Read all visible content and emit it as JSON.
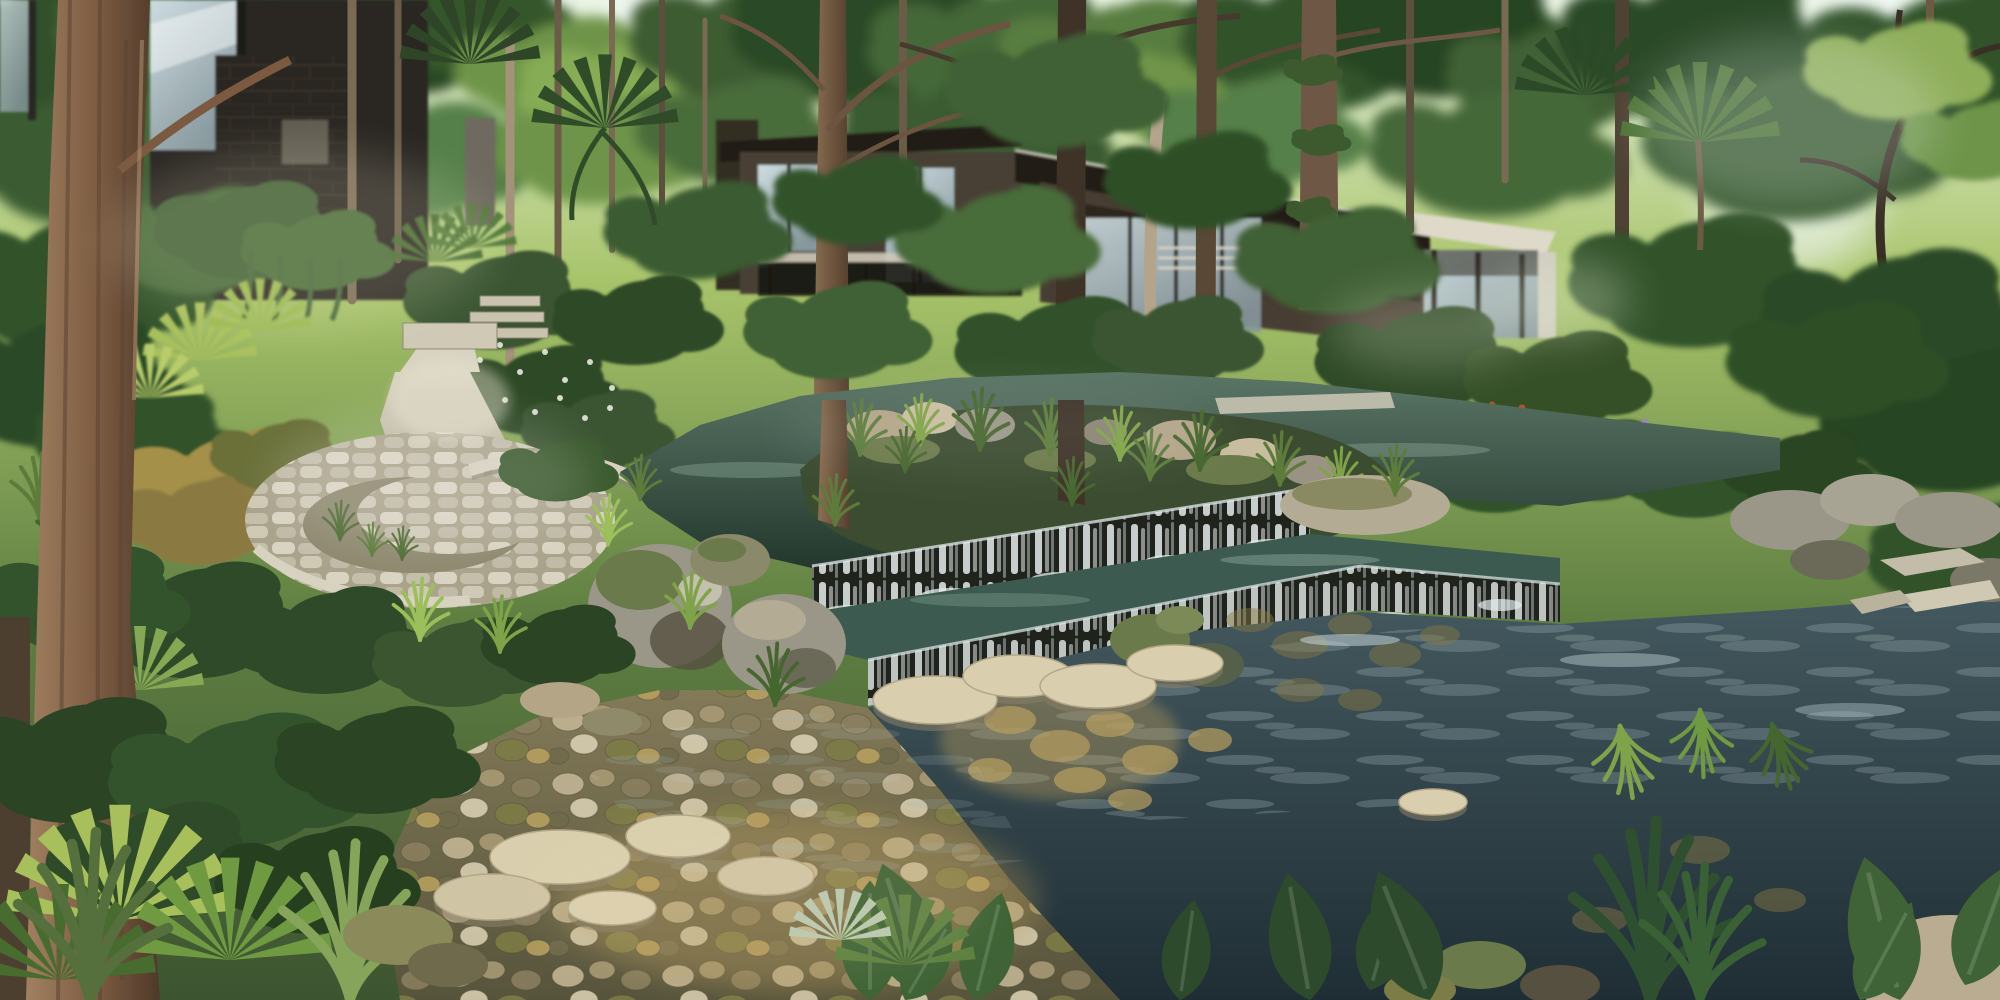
{
  "scene": {
    "title": "Tropical resort garden rendering: modern villas above a rocky stream with weir waterfalls, circular stone terrace and stepping stones",
    "description": "Photorealistic architectural visualization. Dense tree canopy with sky gaps over dark timber-and-glass villas; a winding stone path leads to a circular cobbled terrace with a crescent planter; a teal upper pond with a planted rock island spills over two dark stone weirs into a reflective lower pond; the foreground is a shallow pebble stream with cream stepping stones, boulders and lush tropical planting; tall tree trunks frame the view.",
    "objects": [
      "tree-canopy",
      "sky-gaps",
      "left-villa",
      "center-villa",
      "right-villa",
      "garden-pavilion",
      "glass-facades",
      "stone-path",
      "circular-stone-terrace",
      "crescent-planter",
      "curved-garden-wall",
      "upper-pond",
      "planted-island",
      "weir-waterfall-upper",
      "weir-waterfall-lower",
      "lower-pond",
      "stepping-stones",
      "pebble-stream-bed",
      "boulders",
      "tree-trunks",
      "palms",
      "ferns",
      "hedge-row",
      "flowering-shrubs",
      "foreground-tropical-plants"
    ],
    "palette": {
      "sky": "#f3f9fb",
      "canopy_light": "#a8c46a",
      "canopy_mid": "#5f7f42",
      "canopy_dark": "#2f4526",
      "hedge": "#33522c",
      "building_dark": "#2b2721",
      "building_brown": "#4a4034",
      "roof_dark": "#241f19",
      "fascia_white": "#ded9c9",
      "glass_hi": "#cddce0",
      "glass_lo": "#87989e",
      "trunk_light": "#a0805f",
      "trunk_mid": "#8a6f52",
      "trunk_dark": "#4e3929",
      "trunk_pale": "#b4a48c",
      "path_hi": "#d9d3c2",
      "path_lo": "#aaa38c",
      "wall_light": "#cfc9b6",
      "pond_upper_hi": "#5a7566",
      "pond_upper_lo": "#24382d",
      "pond_lower_hi": "#44595f",
      "pond_lower_lo": "#1f2e35",
      "stream_hi": "#837a58",
      "stream_lo": "#57543c",
      "water_white": "#eef5f6",
      "foam": "#e4edee",
      "rock_hi": "#c9c4b2",
      "rock_mid": "#9a9688",
      "rock_dark": "#55503f",
      "moss": "#6b7a4a",
      "pebble_tan": "#c3b695",
      "pebble_cream": "#d9cfb2",
      "pebble_moss": "#7c7c46",
      "gold_stone": "#b8a060",
      "step_stone": "#d9cfae",
      "step_shadow": "#8a8068",
      "grass_bright": "#7fa348",
      "grass_deep": "#46662f",
      "leaf_dark": "#2e4a2c",
      "leaf_mid": "#3f6336",
      "lime": "#a8c05c",
      "copper": "#a59048",
      "flower_red": "#b0532e",
      "flower_white": "#f2f4ea",
      "flower_purple": "#9a87b5"
    }
  }
}
